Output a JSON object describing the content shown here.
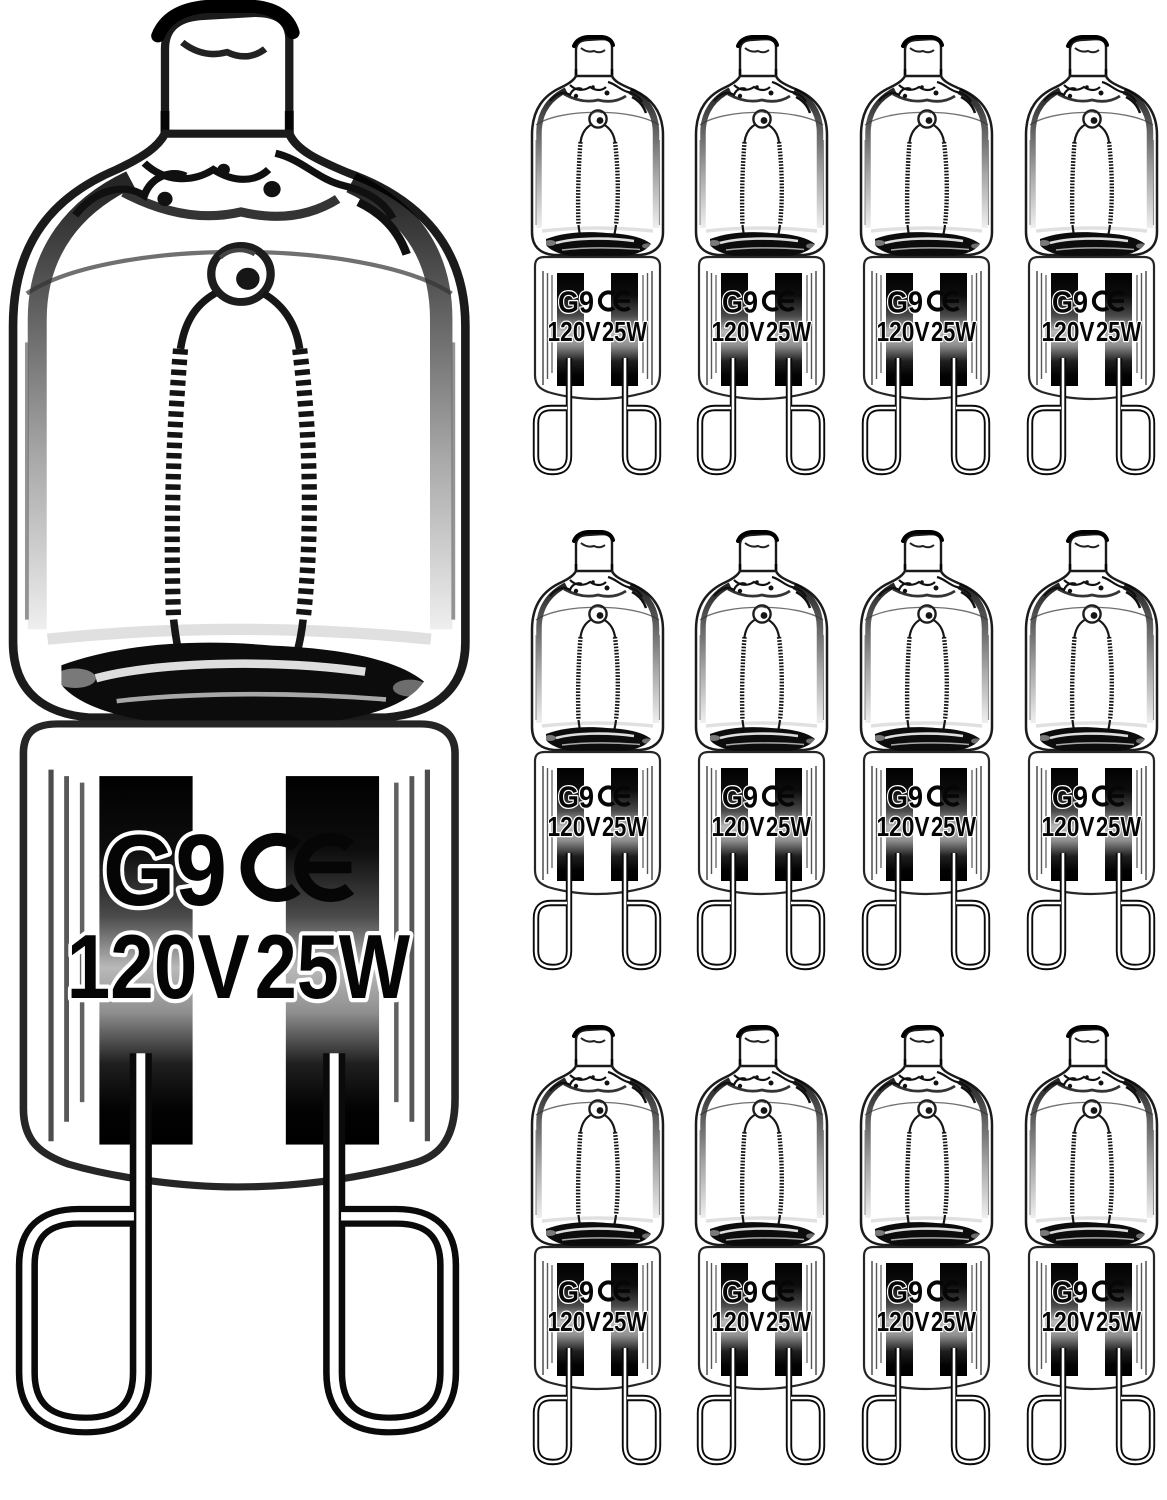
{
  "product_image": {
    "subject": "G9 halogen capsule light bulbs",
    "background_color": "#ffffff",
    "large_bulb_count": 1,
    "thumbnail_grid": {
      "rows": 3,
      "columns": 4,
      "bulb_count": 12
    }
  },
  "bulb_markings": {
    "base_type": "G9",
    "certification_mark": "CE",
    "voltage": "120V",
    "wattage": "25W"
  },
  "colors": {
    "ink": "#050505",
    "text_halo": "#ffffff",
    "bar_dark": "#000000",
    "bar_mid_light": "#b9b9b9",
    "glass_outline": "#1b1b1b",
    "background": "#ffffff"
  }
}
